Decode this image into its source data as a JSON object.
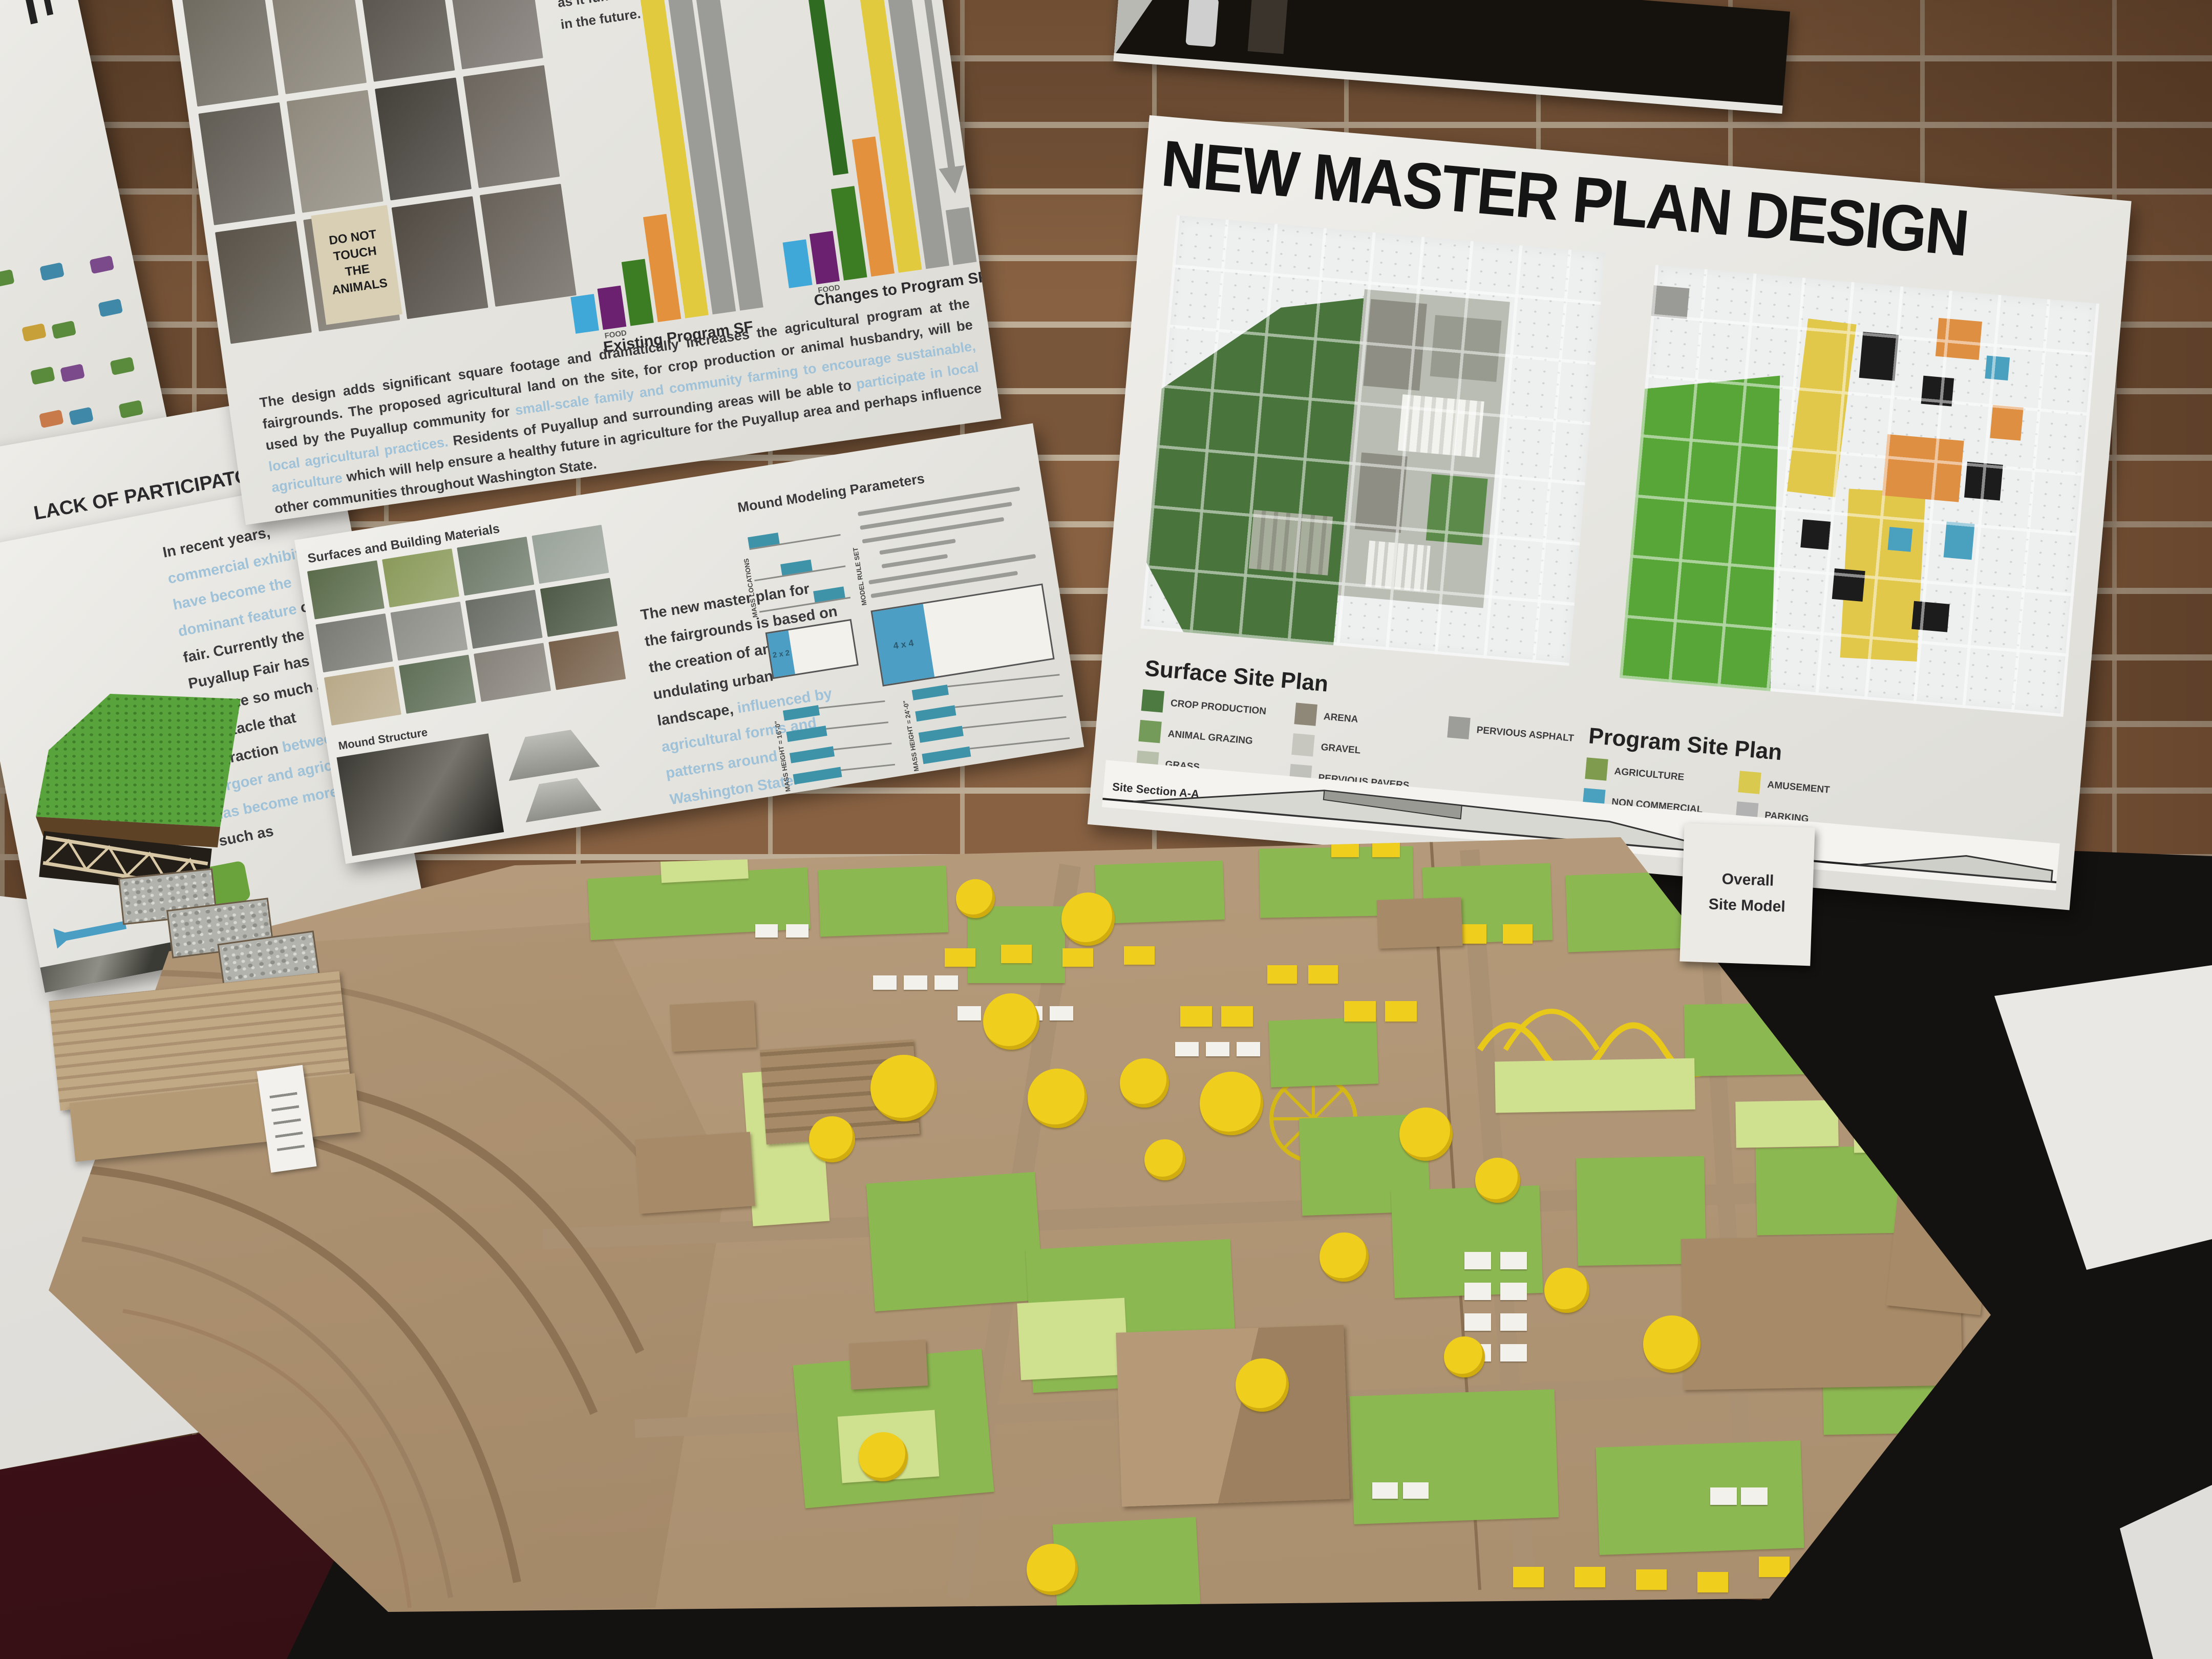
{
  "participatory_poster": {
    "line1": "LACK OF PARTICIPATORY",
    "line2": "EDUCATIONAL EXPERIENCES"
  },
  "recent_years_poster": {
    "segments": [
      {
        "text": "In recent years, ",
        "style": "dark"
      },
      {
        "text": "commercial exhibits have become the dominant feature",
        "style": "light"
      },
      {
        "text": " of the fair.  Currently the Puyallup Fair has become so much a spectacle that interaction ",
        "style": "dark"
      },
      {
        "text": "between the fairgoer and agriculture has become more",
        "style": "light"
      },
      {
        "text": ", such as",
        "style": "dark"
      }
    ]
  },
  "left_icon_strip": {
    "icon_colors": [
      "#5a8a3c",
      "#3f88a8",
      "#7a4a8a",
      "#c8a03a",
      "#5a8a3c",
      "#3f88a8",
      "#5a8a3c",
      "#7a4a8a",
      "#5a8a3c",
      "#c87a4a",
      "#3f88a8",
      "#5a8a3c"
    ]
  },
  "program_poster": {
    "side_text_lines": [
      "not simply try to re-",
      "to agricultural",
      "experiences of the past,",
      "but would connect the",
      "fairgoer to agriculture",
      "as it functions today and",
      "in the future."
    ],
    "photo_sign": {
      "line1": "DO NOT",
      "line2": "TOUCH",
      "line3": "THE",
      "line4": "ANIMALS"
    },
    "photo_tiles": [
      "#6a6a64",
      "#4a4a42",
      "#7a7468",
      "#3c3c36",
      "#8a8478",
      "#5a5a52",
      "#9a948a",
      "#4e4e46",
      "#6e6a60",
      "#857f73",
      "#56524a",
      "#76706a",
      "#615d55",
      "#8f897d",
      "#44403a",
      "#6c665e",
      "#595349",
      "#7d776d",
      "#504a42",
      "#68625a"
    ],
    "paragraph_segments": [
      {
        "text": "The design adds significant square footage and dramatically increases the agricultural program at the fairgrounds.  The proposed agricultural land on the site, for crop production or animal husbandry, will be used by the Puyallup community for ",
        "style": "dark"
      },
      {
        "text": "small-scale family and community farming to encourage sustainable, local agricultural practices.",
        "style": "light"
      },
      {
        "text": " Residents of Puyallup and surrounding areas will be able to ",
        "style": "dark"
      },
      {
        "text": "participate in local agriculture",
        "style": "light"
      },
      {
        "text": " which will help ensure a healthy future in agriculture for the Puyallup area and perhaps influence other communities throughout Washington State.",
        "style": "dark"
      }
    ]
  },
  "chart_data": [
    {
      "type": "bar",
      "title": "Existing Program SF",
      "categories": [
        "",
        "FOOD",
        "",
        "",
        "",
        "",
        ""
      ],
      "values": [
        8,
        9,
        14,
        23,
        72,
        130,
        130
      ],
      "colors": [
        "#3fa8d8",
        "#6b2070",
        "#3c7d24",
        "#e3913c",
        "#e2ca3e",
        "#9b9b97",
        "#9b9b97"
      ],
      "ylabel": "",
      "note": "gray bars extend beyond top of poster"
    },
    {
      "type": "bar",
      "title": "Changes to Program SF",
      "categories": [
        "",
        "FOOD",
        "",
        "",
        "",
        "",
        ""
      ],
      "values": [
        10,
        11,
        20,
        30,
        72,
        140,
        12
      ],
      "colors": [
        "#3fa8d8",
        "#6b2070",
        "#3c7d24",
        "#e3913c",
        "#e2ca3e",
        "#9b9b97",
        "#9b9b97"
      ],
      "extras": {
        "extension_index": 2,
        "extension_color": "#2f6b20",
        "yellow_arrow_index": 4,
        "yellow_arrow_color": "#d8c23a",
        "gray_arrow_index": 6,
        "gray_arrow_color": "#9b9b97"
      }
    }
  ],
  "mound_poster": {
    "materials_heading": "Surfaces and Building Materials",
    "structure_heading": "Mound Structure",
    "photo_tiles": [
      "#5a6b4a",
      "#8a9a5a",
      "#6e7a6a",
      "#9aa39a",
      "#7a7a74",
      "#8f8f89",
      "#6a6e66",
      "#4e5a46",
      "#b8a988",
      "#5f6f57",
      "#86827a",
      "#76604a"
    ],
    "body_segments": [
      {
        "text": "The new master plan for the fairgrounds is based on the creation of an undulating urban landscape, ",
        "style": "dark"
      },
      {
        "text": "influenced by agricultural forms and patterns around Washington State.",
        "style": "light"
      }
    ],
    "parameters": {
      "heading": "Mound Modeling Parameters",
      "mass_locations_label": "MASS LOCATIONS",
      "rule_set_label": "MODEL RULE SET",
      "grid_labels": [
        "2 x 2",
        "4 x 4"
      ],
      "mass_height_labels": [
        "MASS HEIGHT = 16'-0\"",
        "MASS HEIGHT = 24'-0\""
      ],
      "bar_color": "#3e93a8"
    }
  },
  "master_plan_poster": {
    "title": "NEW MASTER PLAN DESIGN",
    "surface_site_plan": {
      "title": "Surface Site Plan",
      "items": [
        {
          "label": "CROP PRODUCTION",
          "color": "#4d7a40"
        },
        {
          "label": "ANIMAL GRAZING",
          "color": "#749b59"
        },
        {
          "label": "GRASS",
          "color": "#b8bfab"
        },
        {
          "label": "ARENA",
          "color": "#8f8777"
        },
        {
          "label": "GRAVEL",
          "color": "#c7c7c0"
        },
        {
          "label": "PERVIOUS PAVERS",
          "color": "#c1c1bb"
        },
        {
          "label": "PERVIOUS ASPHALT",
          "color": "#9d9d99"
        }
      ]
    },
    "program_site_plan": {
      "title": "Program Site Plan",
      "items": [
        {
          "label": "AGRICULTURE",
          "color": "#7f9c4e"
        },
        {
          "label": "NON COMMERCIAL",
          "color": "#49a0bf"
        },
        {
          "label": "COMMERCIAL",
          "color": "#df8f41"
        },
        {
          "label": "AMUSEMENT",
          "color": "#d9c94e"
        },
        {
          "label": "PARKING",
          "color": "#b2b2b2"
        }
      ]
    },
    "section_caption": "Site Section A-A"
  },
  "site_model_card": {
    "line1": "Overall",
    "line2": "Site Model"
  },
  "site_model": {
    "board_color": "#b69c7c",
    "greens": [
      "#8cb852",
      "#cfe08f"
    ],
    "ride_color": "#f0ce1d",
    "scenery": {
      "rects": [
        [
          "g",
          1150,
          1705,
          430,
          120,
          -3
        ],
        [
          "g",
          1600,
          1695,
          250,
          130,
          -2
        ],
        [
          "g",
          1890,
          1770,
          190,
          150,
          0
        ],
        [
          "g",
          2140,
          1685,
          250,
          115,
          -2
        ],
        [
          "g",
          2460,
          1655,
          300,
          135,
          -1
        ],
        [
          "g",
          2780,
          1690,
          250,
          150,
          -2
        ],
        [
          "g",
          3060,
          1705,
          270,
          150,
          -2
        ],
        [
          "g",
          1700,
          2300,
          330,
          250,
          -4
        ],
        [
          "g",
          2010,
          2430,
          400,
          280,
          -3
        ],
        [
          "g",
          2540,
          2180,
          250,
          190,
          -2
        ],
        [
          "g",
          2720,
          2320,
          290,
          210,
          -2
        ],
        [
          "g",
          3080,
          2260,
          250,
          210,
          -1
        ],
        [
          "g",
          3430,
          2240,
          290,
          170,
          -1
        ],
        [
          "g",
          1560,
          2650,
          370,
          280,
          -5
        ],
        [
          "g",
          2640,
          2720,
          400,
          250,
          -2
        ],
        [
          "g",
          3120,
          2820,
          400,
          210,
          -2
        ],
        [
          "g",
          2060,
          2970,
          280,
          170,
          -3
        ],
        [
          "g",
          2480,
          1990,
          210,
          130,
          -2
        ],
        [
          "g",
          3290,
          1960,
          240,
          140,
          -1
        ],
        [
          "g",
          3560,
          2600,
          260,
          200,
          -1
        ],
        [
          "gl",
          1290,
          1645,
          170,
          75,
          -3
        ],
        [
          "gl",
          1990,
          2540,
          210,
          150,
          -3
        ],
        [
          "gl",
          1640,
          2760,
          190,
          130,
          -4
        ],
        [
          "gl",
          2920,
          2070,
          390,
          100,
          -1
        ],
        [
          "gl",
          3390,
          2150,
          200,
          90,
          -1
        ],
        [
          "gl",
          2210,
          2620,
          180,
          120,
          -2
        ],
        [
          "gl",
          1460,
          2090,
          150,
          300,
          -4
        ],
        [
          "gl",
          3620,
          2130,
          180,
          120,
          -1
        ],
        [
          "y",
          1845,
          1852,
          60,
          36,
          0
        ],
        [
          "y",
          1955,
          1845,
          60,
          36,
          0
        ],
        [
          "y",
          2075,
          1852,
          60,
          36,
          0
        ],
        [
          "y",
          2195,
          1848,
          60,
          36,
          0
        ],
        [
          "y",
          2625,
          1955,
          62,
          40,
          0
        ],
        [
          "y",
          2705,
          1955,
          62,
          40,
          0
        ],
        [
          "y",
          2475,
          1885,
          58,
          36,
          0
        ],
        [
          "y",
          2555,
          1885,
          58,
          36,
          0
        ],
        [
          "y",
          2845,
          1805,
          58,
          38,
          0
        ],
        [
          "y",
          2935,
          1805,
          58,
          38,
          0
        ],
        [
          "y",
          2305,
          1965,
          62,
          40,
          0
        ],
        [
          "y",
          2385,
          1965,
          62,
          40,
          0
        ],
        [
          "y",
          3435,
          1825,
          54,
          34,
          0
        ],
        [
          "y",
          3505,
          1875,
          54,
          34,
          0
        ],
        [
          "y",
          2955,
          3060,
          60,
          40,
          0
        ],
        [
          "y",
          3075,
          3060,
          60,
          40,
          0
        ],
        [
          "y",
          3195,
          3065,
          60,
          40,
          0
        ],
        [
          "y",
          3315,
          3070,
          60,
          40,
          0
        ],
        [
          "y",
          3435,
          3040,
          60,
          40,
          0
        ],
        [
          "y",
          2600,
          1640,
          54,
          34,
          0
        ],
        [
          "y",
          2680,
          1640,
          54,
          34,
          0
        ],
        [
          "w",
          1705,
          1905,
          46,
          28,
          0
        ],
        [
          "w",
          1765,
          1905,
          46,
          28,
          0
        ],
        [
          "w",
          1825,
          1905,
          46,
          28,
          0
        ],
        [
          "w",
          1870,
          1965,
          46,
          28,
          0
        ],
        [
          "w",
          1930,
          1965,
          46,
          28,
          0
        ],
        [
          "w",
          1990,
          1965,
          46,
          28,
          0
        ],
        [
          "w",
          2050,
          1965,
          46,
          28,
          0
        ],
        [
          "w",
          2295,
          2035,
          46,
          28,
          0
        ],
        [
          "w",
          2355,
          2035,
          46,
          28,
          0
        ],
        [
          "w",
          2415,
          2035,
          46,
          28,
          0
        ],
        [
          "w",
          2860,
          2445,
          52,
          34,
          0
        ],
        [
          "w",
          2930,
          2445,
          52,
          34,
          0
        ],
        [
          "w",
          2860,
          2505,
          52,
          34,
          0
        ],
        [
          "w",
          2930,
          2505,
          52,
          34,
          0
        ],
        [
          "w",
          2860,
          2565,
          52,
          34,
          0
        ],
        [
          "w",
          2930,
          2565,
          52,
          34,
          0
        ],
        [
          "w",
          2860,
          2625,
          52,
          34,
          0
        ],
        [
          "w",
          2930,
          2625,
          52,
          34,
          0
        ],
        [
          "w",
          2340,
          2825,
          50,
          32,
          0
        ],
        [
          "w",
          2400,
          2825,
          50,
          32,
          0
        ],
        [
          "w",
          2460,
          2825,
          50,
          32,
          0
        ],
        [
          "w",
          2680,
          2895,
          50,
          32,
          0
        ],
        [
          "w",
          2740,
          2895,
          50,
          32,
          0
        ],
        [
          "w",
          3340,
          2905,
          52,
          34,
          0
        ],
        [
          "w",
          3400,
          2905,
          52,
          34,
          0
        ],
        [
          "w",
          1475,
          1805,
          44,
          26,
          0
        ],
        [
          "w",
          1535,
          1805,
          44,
          26,
          0
        ],
        [
          "bs",
          1490,
          2040,
          300,
          185,
          -4
        ],
        [
          "b",
          1310,
          1958,
          165,
          92,
          -3
        ],
        [
          "b",
          1245,
          2218,
          225,
          145,
          -4
        ],
        [
          "bp",
          2185,
          2595,
          445,
          340,
          -2
        ],
        [
          "b",
          3285,
          2415,
          545,
          295,
          -1
        ],
        [
          "b",
          3705,
          2140,
          185,
          420,
          6
        ],
        [
          "b",
          2690,
          1755,
          165,
          95,
          -2
        ],
        [
          "b",
          1660,
          2620,
          150,
          90,
          -3
        ]
      ],
      "circles": [
        [
          1975,
          1995,
          55
        ],
        [
          1765,
          2125,
          65
        ],
        [
          1625,
          2225,
          45
        ],
        [
          2065,
          2145,
          58
        ],
        [
          2235,
          2115,
          48
        ],
        [
          2405,
          2155,
          62
        ],
        [
          2275,
          2265,
          40
        ],
        [
          2125,
          1795,
          52
        ],
        [
          1905,
          1755,
          38
        ],
        [
          2785,
          2215,
          52
        ],
        [
          2925,
          2305,
          44
        ],
        [
          2625,
          2455,
          48
        ],
        [
          2465,
          2705,
          52
        ],
        [
          3265,
          2625,
          56
        ],
        [
          2055,
          3065,
          50
        ],
        [
          1725,
          2845,
          48
        ],
        [
          2860,
          2650,
          40
        ],
        [
          3060,
          2520,
          44
        ]
      ]
    }
  }
}
